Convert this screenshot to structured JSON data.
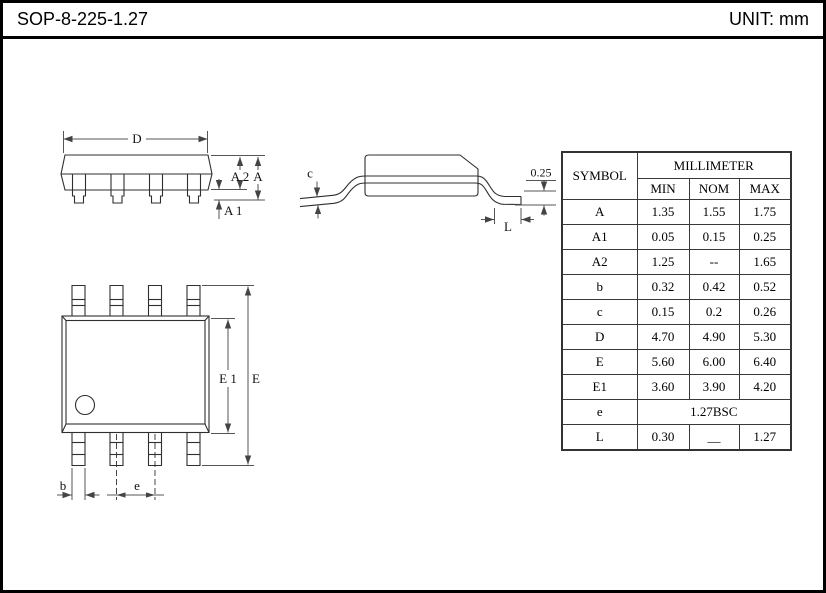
{
  "header": {
    "title": "SOP-8-225-1.27",
    "unit": "UNIT: mm"
  },
  "table": {
    "header": {
      "symbol": "SYMBOL",
      "group": "MILLIMETER",
      "min": "MIN",
      "nom": "NOM",
      "max": "MAX"
    },
    "rows": [
      {
        "symbol": "A",
        "min": "1.35",
        "nom": "1.55",
        "max": "1.75"
      },
      {
        "symbol": "A1",
        "min": "0.05",
        "nom": "0.15",
        "max": "0.25"
      },
      {
        "symbol": "A2",
        "min": "1.25",
        "nom": "--",
        "max": "1.65"
      },
      {
        "symbol": "b",
        "min": "0.32",
        "nom": "0.42",
        "max": "0.52"
      },
      {
        "symbol": "c",
        "min": "0.15",
        "nom": "0.2",
        "max": "0.26"
      },
      {
        "symbol": "D",
        "min": "4.70",
        "nom": "4.90",
        "max": "5.30"
      },
      {
        "symbol": "E",
        "min": "5.60",
        "nom": "6.00",
        "max": "6.40"
      },
      {
        "symbol": "E1",
        "min": "3.60",
        "nom": "3.90",
        "max": "4.20"
      },
      {
        "symbol": "e",
        "span": "1.27BSC"
      },
      {
        "symbol": "L",
        "min": "0.30",
        "nom": "__",
        "max": "1.27"
      }
    ]
  },
  "drawings": {
    "side_view": {
      "labels": {
        "D": "D",
        "A2": "A 2",
        "A": "A",
        "A1": "A 1"
      }
    },
    "end_view": {
      "labels": {
        "c": "c",
        "offset": "0.25",
        "L": "L"
      }
    },
    "top_view": {
      "labels": {
        "E1": "E 1",
        "E": "E",
        "b": "b",
        "e": "e"
      }
    }
  }
}
